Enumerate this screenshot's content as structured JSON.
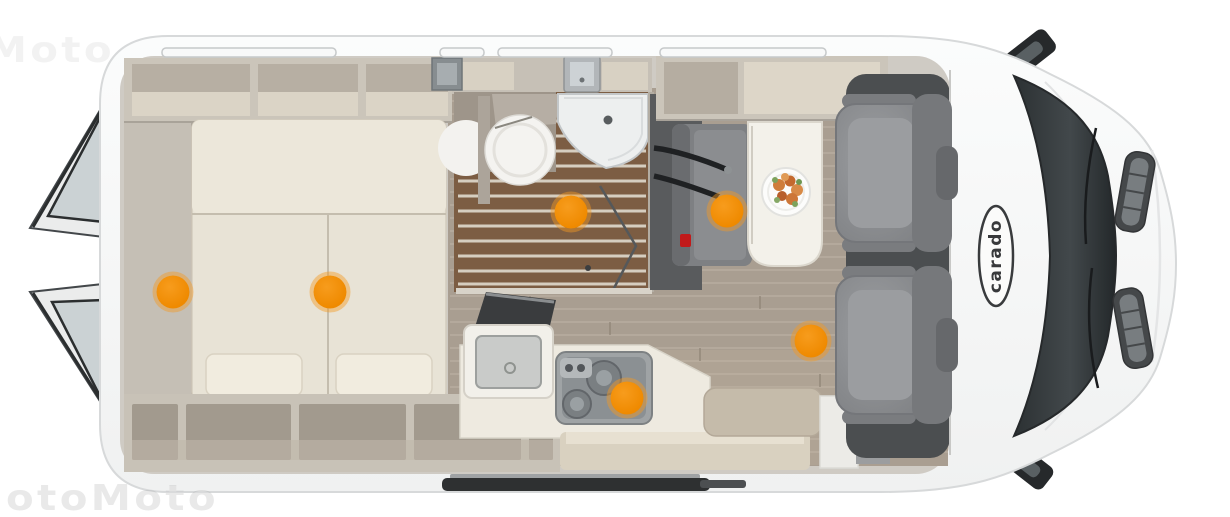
{
  "image": {
    "brand_label": "carado",
    "type_label": "camper-van-top-view-floorplan"
  },
  "watermark": {
    "text": "otoMoto"
  },
  "colors": {
    "accent-orange": "#EF8A00",
    "body-white": "#f8f9f9",
    "wall-taupe": "#c9c3b9",
    "floor-wood": "#a99e91",
    "bathroom-teak": "#7c5d43",
    "mattress-cream": "#e8e3d6",
    "seat-gray": "#8b8d90",
    "glass-dark": "#33383a",
    "table-white": "#f3f1ea"
  },
  "hotspots": [
    {
      "name": "hotspot-rear-storage",
      "x": 173,
      "y": 292
    },
    {
      "name": "hotspot-bed",
      "x": 330,
      "y": 292
    },
    {
      "name": "hotspot-bathroom",
      "x": 571,
      "y": 212
    },
    {
      "name": "hotspot-dinette",
      "x": 727,
      "y": 211
    },
    {
      "name": "hotspot-kitchen",
      "x": 627,
      "y": 398
    },
    {
      "name": "hotspot-living-area",
      "x": 811,
      "y": 341
    }
  ]
}
